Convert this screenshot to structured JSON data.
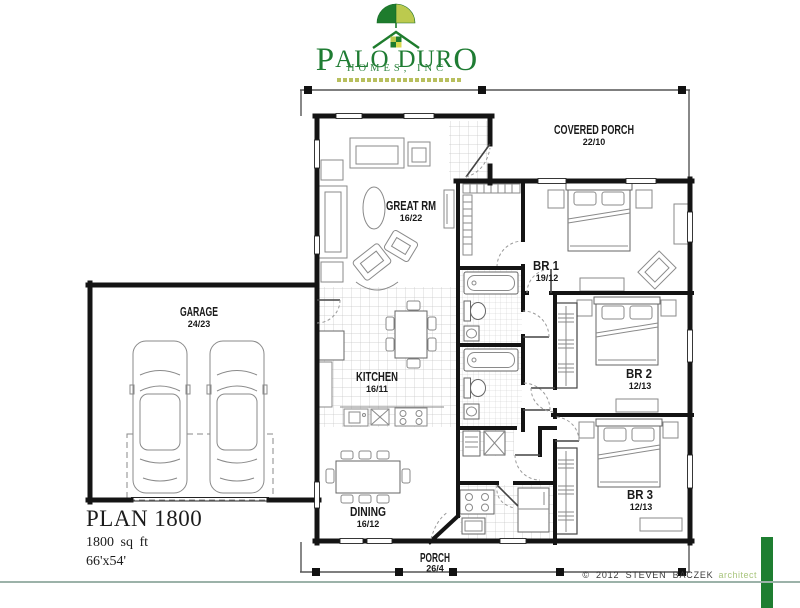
{
  "logo": {
    "p": "P",
    "alo": "ALO",
    "d": "D",
    "ur": "UR",
    "o": "O",
    "subtitle": "HOMES, INC"
  },
  "rooms": {
    "covered_porch": {
      "label": "COVERED PORCH",
      "dims": "22/10"
    },
    "great_rm": {
      "label": "GREAT RM",
      "dims": "16/22"
    },
    "br1": {
      "label": "BR 1",
      "dims": "19/12"
    },
    "br2": {
      "label": "BR 2",
      "dims": "12/13"
    },
    "br3": {
      "label": "BR 3",
      "dims": "12/13"
    },
    "kitchen": {
      "label": "KITCHEN",
      "dims": "16/11"
    },
    "dining": {
      "label": "DINING",
      "dims": "16/12"
    },
    "garage": {
      "label": "GARAGE",
      "dims": "24/23"
    },
    "porch": {
      "label": "PORCH",
      "dims": "26/4"
    }
  },
  "plan_info": {
    "title": "PLAN 1800",
    "area": "1800 sq ft",
    "footprint": "66'x54'"
  },
  "footer": {
    "copyright": "© 2012  STEVEN  BACZEK",
    "role": "architect"
  },
  "colors": {
    "brand_dark_green": "#1e7c2d",
    "brand_light_green": "#bcca4e",
    "accent_bar": "#1e7e31",
    "footer_line": "#9cb2a9"
  }
}
